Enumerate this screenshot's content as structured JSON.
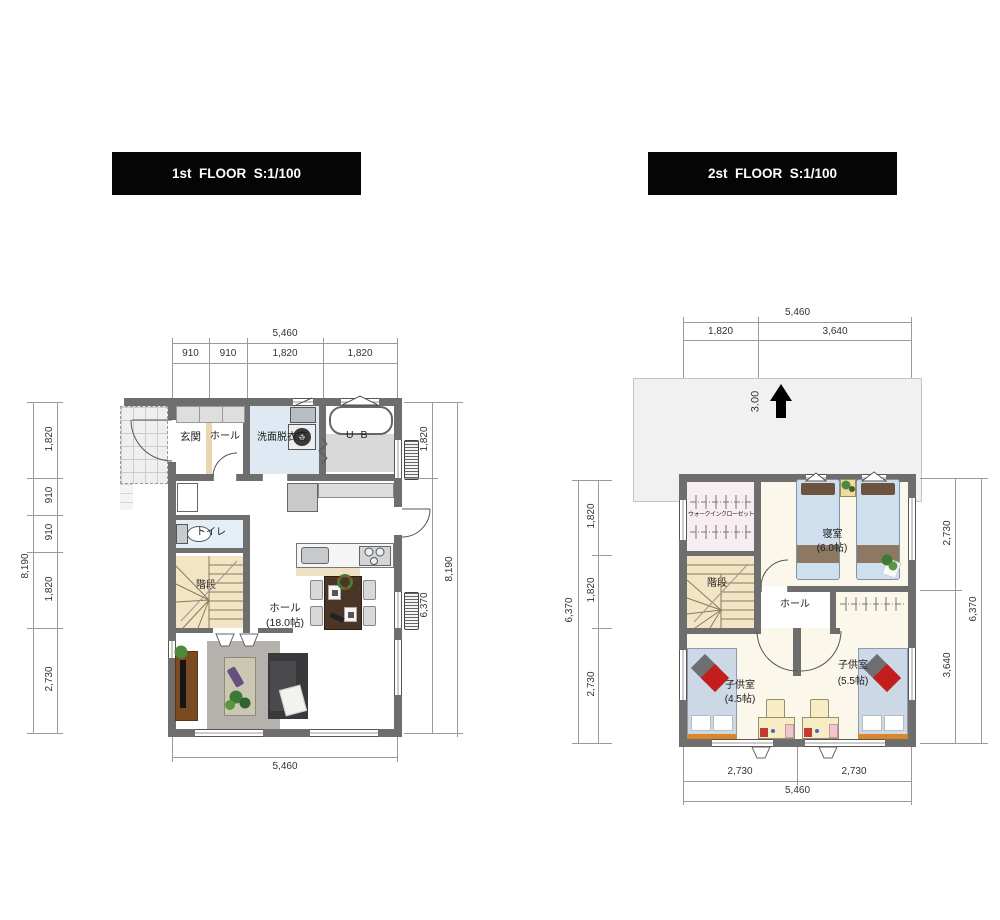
{
  "floor1": {
    "title": "1st  FLOOR  S:1/100",
    "rooms": {
      "entrance": "玄関",
      "entrance_hall": "ホール",
      "washroom": "洗面脱衣室",
      "bath": "U B",
      "toilet": "トイレ",
      "stairs": "階段",
      "living_name": "ホール",
      "living_size": "(18.0帖)"
    },
    "dims": {
      "top_total": "5,460",
      "top_segs": [
        "910",
        "910",
        "1,820",
        "1,820"
      ],
      "left_total": "8,190",
      "left_segs": [
        "1,820",
        "910",
        "910",
        "1,820",
        "2,730"
      ],
      "right_total": "8,190",
      "right_segs": [
        "1,820",
        "6,370"
      ],
      "bottom_total": "5,460"
    }
  },
  "floor2": {
    "title": "2st  FLOOR  S:1/100",
    "roof_pitch": "3.00",
    "rooms": {
      "wic": "ウォークインクローゼット",
      "bedroom_name": "寝室",
      "bedroom_size": "(6.0帖)",
      "stairs": "階段",
      "hall": "ホール",
      "kids1_name": "子供室",
      "kids1_size": "(4.5帖)",
      "kids2_name": "子供室",
      "kids2_size": "(5.5帖)"
    },
    "dims": {
      "top_total": "5,460",
      "top_segs": [
        "1,820",
        "3,640"
      ],
      "left_total": "6,370",
      "left_segs": [
        "1,820",
        "1,820",
        "2,730"
      ],
      "right_total": "6,370",
      "right_segs": [
        "2,730",
        "3,640"
      ],
      "bottom_segs": [
        "2,730",
        "2,730"
      ],
      "bottom_total": "5,460"
    }
  }
}
